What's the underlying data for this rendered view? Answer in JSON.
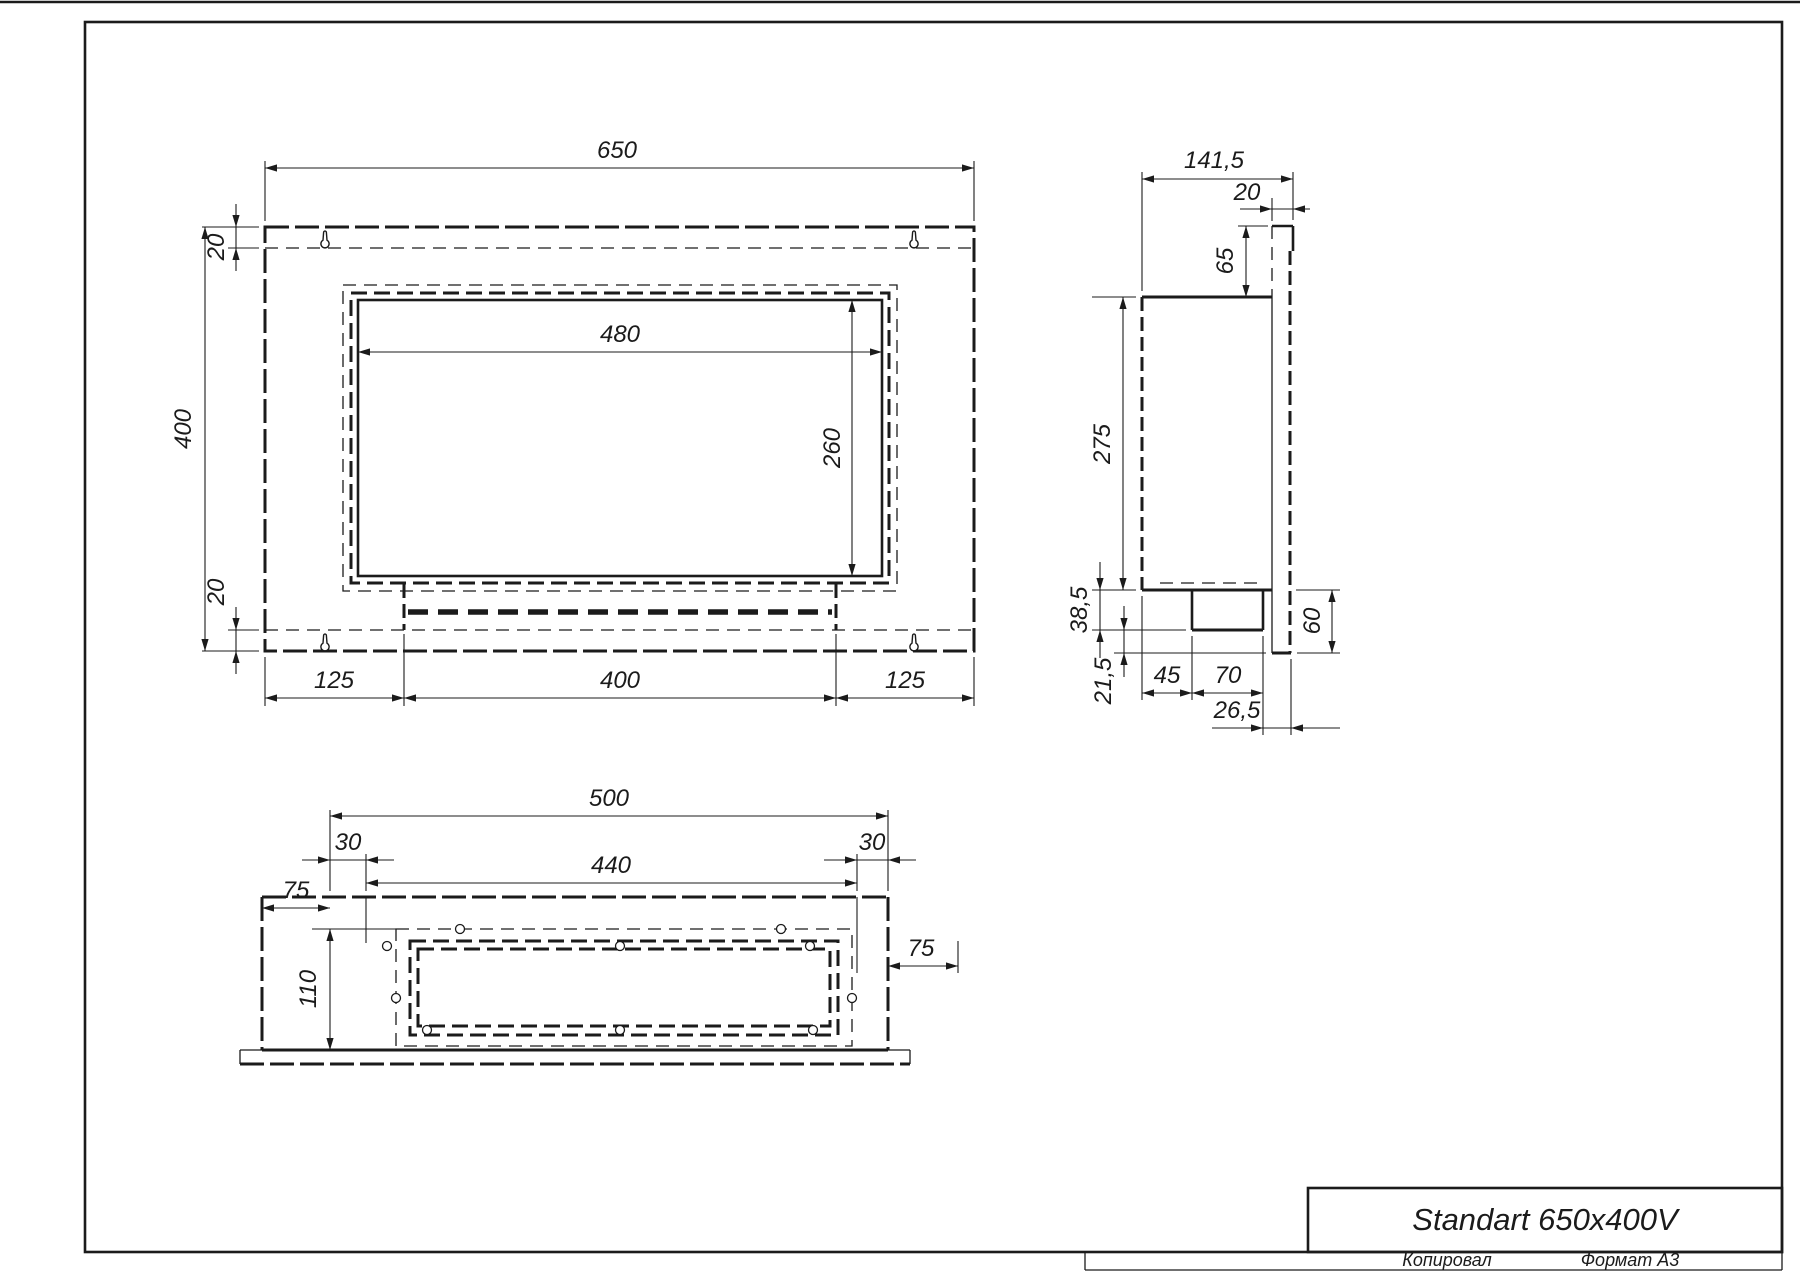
{
  "title_block": {
    "title": "Standart 650x400V",
    "footer_left": "Копировал",
    "footer_right": "Формат А3"
  },
  "icons": {
    "keyhole_slot": "keyhole-mounting-slot",
    "screw_hole": "screw-hole"
  },
  "front_view": {
    "dims": {
      "total_width": "650",
      "total_height": "400",
      "top_offset": "20",
      "bottom_offset": "20",
      "opening_width": "480",
      "opening_height": "260",
      "bottom_left_offset": "125",
      "burner_width": "400",
      "bottom_right_offset": "125"
    }
  },
  "side_view": {
    "dims": {
      "total_depth": "141,5",
      "panel_thickness": "20",
      "flange_height": "65",
      "body_height": "275",
      "tank_height": "38,5",
      "bottom_lip": "21,5",
      "tank_front_offset": "45",
      "tank_width": "70",
      "tank_rear_offset": "26,5",
      "panel_overhang": "60"
    }
  },
  "bottom_view": {
    "dims": {
      "box_width": "500",
      "inset_left": "30",
      "opening_width": "440",
      "inset_right": "30",
      "flange_left": "75",
      "box_depth": "110",
      "flange_right": "75"
    }
  }
}
